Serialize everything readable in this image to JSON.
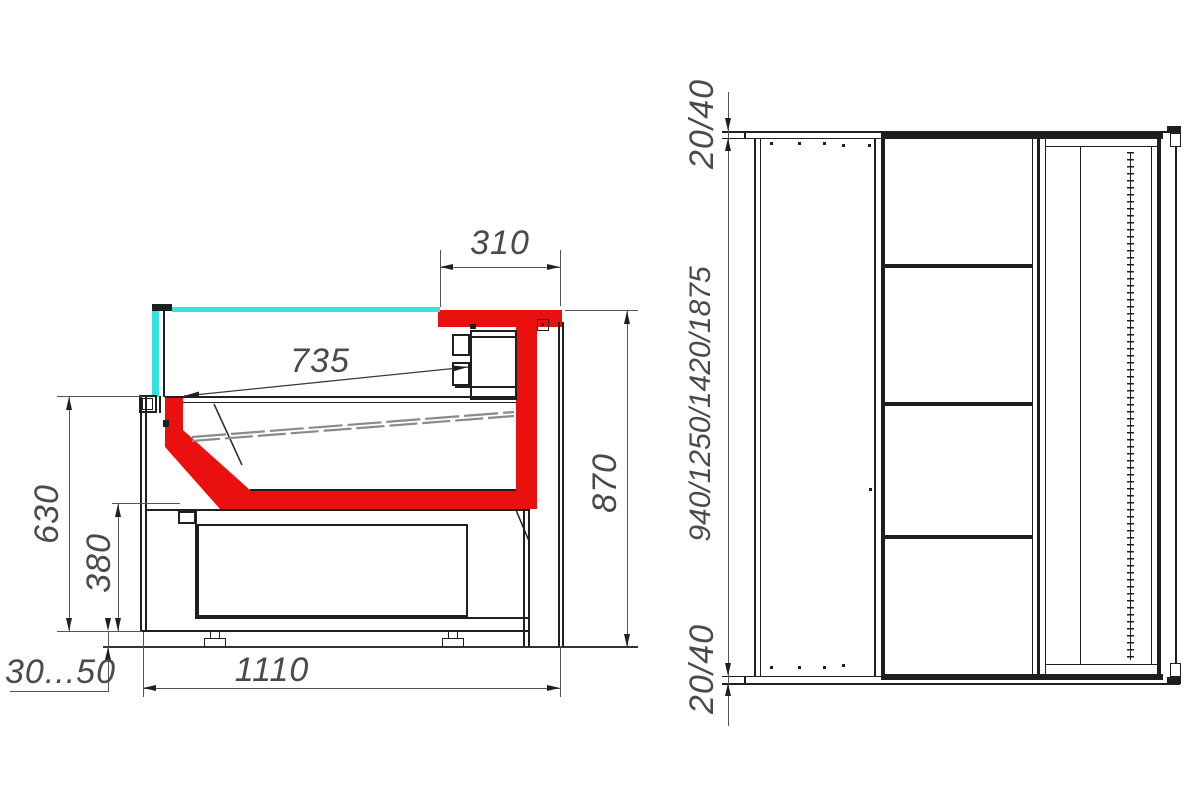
{
  "drawing": {
    "background": "#ffffff",
    "accent_red": "#ea1010",
    "glass_cyan": "#35e2e2",
    "line_color": "#1f1f1f",
    "dim_color": "#4a4a4a",
    "side_view": {
      "name": "side-section-view",
      "dim_top_overhang": "310",
      "dim_deck_length": "735",
      "dim_front_height": "630",
      "dim_base_height": "380",
      "dim_overall_height": "870",
      "dim_overall_depth": "1110",
      "dim_feet_range": "30...50"
    },
    "plan_view": {
      "name": "plan-view",
      "dim_end_top": "20/40",
      "dim_length_options": "940/1250/1420/1875",
      "dim_end_bottom": "20/40"
    }
  }
}
